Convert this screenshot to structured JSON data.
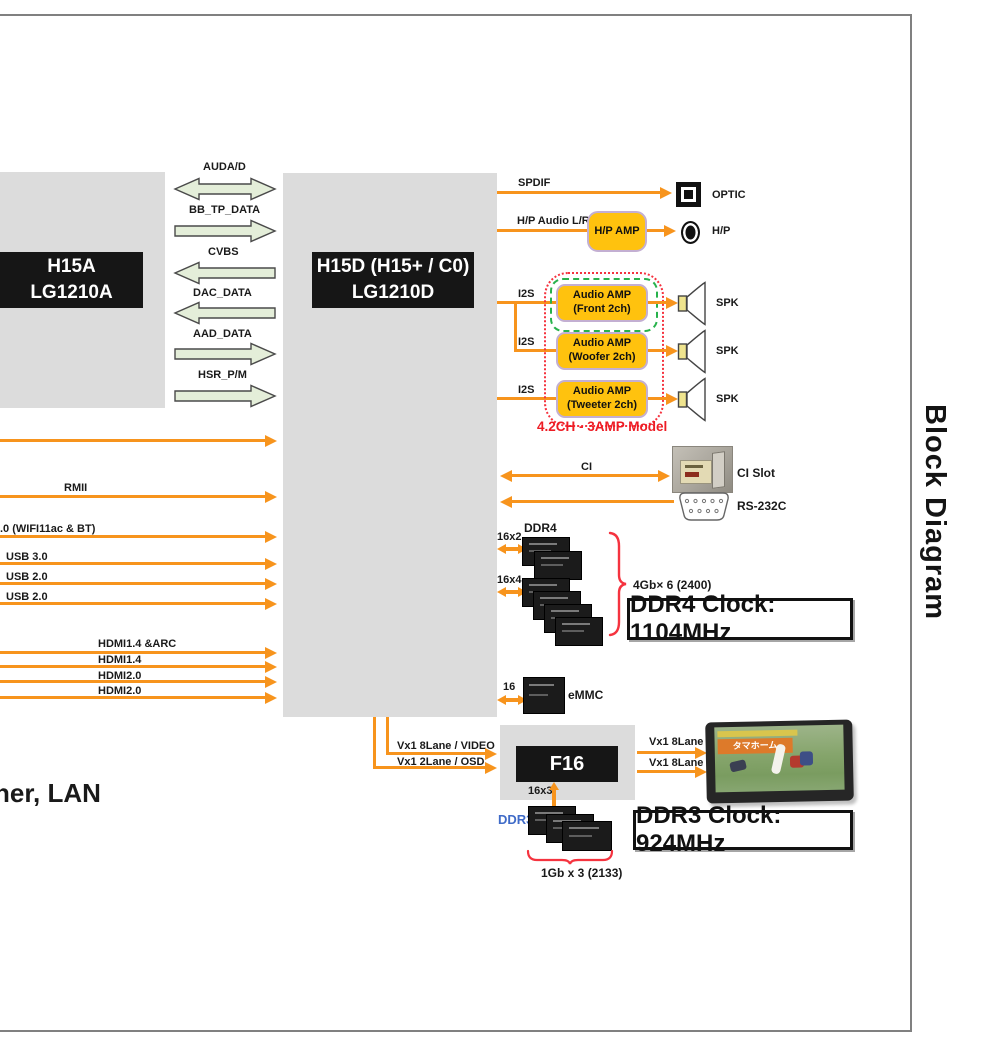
{
  "page": {
    "side_title": "Block Diagram",
    "bottom_left_partial": "ner, LAN",
    "accent_orange": "#F7941D",
    "amp_yellow": "#FFC20E",
    "note_red": "#ED1C24"
  },
  "soc_left": {
    "line1": "H15A",
    "line2": "LG1210A"
  },
  "soc_main": {
    "line1": "H15D (H15+ / C0)",
    "line2": "LG1210D"
  },
  "buses_between_socs": [
    {
      "label": "AUDA/D",
      "dir": "both"
    },
    {
      "label": "BB_TP_DATA",
      "dir": "right"
    },
    {
      "label": "CVBS",
      "dir": "left"
    },
    {
      "label": "DAC_DATA",
      "dir": "left"
    },
    {
      "label": "AAD_DATA",
      "dir": "right"
    },
    {
      "label": "HSR_P/M",
      "dir": "right"
    }
  ],
  "left_inputs": [
    {
      "label": "RMII"
    },
    {
      "label": ".0 (WIFI11ac & BT)"
    },
    {
      "label": "USB 3.0"
    },
    {
      "label": "USB 2.0"
    },
    {
      "label": "USB 2.0"
    },
    {
      "label": "HDMI1.4 &ARC"
    },
    {
      "label": "HDMI1.4"
    },
    {
      "label": "HDMI2.0"
    },
    {
      "label": "HDMI2.0"
    }
  ],
  "audio": {
    "spdif_label": "SPDIF",
    "optic_label": "OPTIC",
    "hp_audio_label": "H/P Audio L/R",
    "hp_amp_label": "H/P AMP",
    "hp_label": "H/P",
    "i2s_label": "I2S",
    "amps": [
      {
        "line1": "Audio AMP",
        "line2": "(Front 2ch)"
      },
      {
        "line1": "Audio AMP",
        "line2": "(Woofer 2ch)"
      },
      {
        "line1": "Audio AMP",
        "line2": "(Tweeter 2ch)"
      }
    ],
    "spk_label": "SPK",
    "model_note": "4.2CH - 3AMP Model"
  },
  "ci": {
    "bus_label": "CI",
    "slot_label": "CI Slot"
  },
  "rs232": {
    "label": "RS-232C"
  },
  "ddr4": {
    "title": "DDR4",
    "bus1": "16x2",
    "bus2": "16x4",
    "capacity": "4Gb× 6 (2400)",
    "clock": "DDR4 Clock: 1104MHz"
  },
  "emmc": {
    "bus": "16",
    "label": "eMMC"
  },
  "f16": {
    "name": "F16",
    "in1": "Vx1 8Lane / VIDEO",
    "in2": "Vx1 2Lane / OSD",
    "out1": "Vx1 8Lane",
    "out2": "Vx1 8Lane",
    "mem_bus": "16x3"
  },
  "ddr3": {
    "label": "DDR3",
    "label_color": "#3f6bc8",
    "capacity": "1Gb x 3 (2133)",
    "clock": "DDR3 Clock: 924MHz"
  },
  "tv": {
    "banner": "タマホーム"
  }
}
